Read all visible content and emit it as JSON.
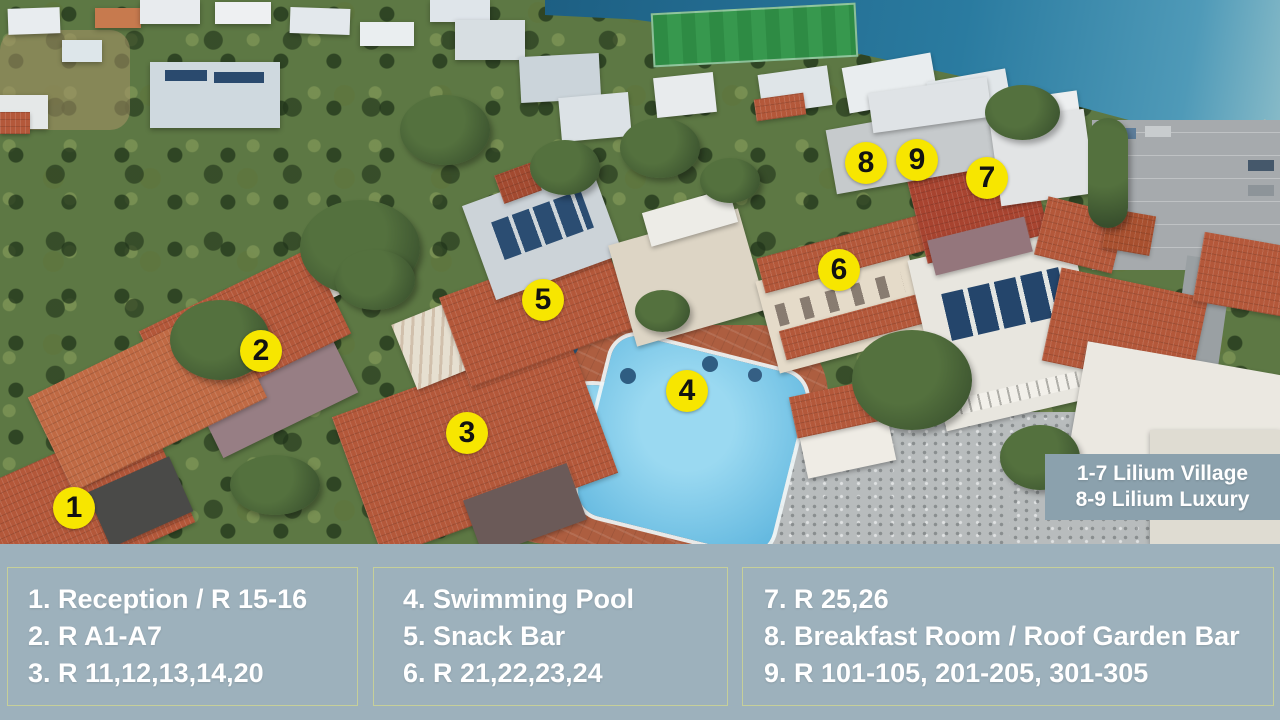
{
  "scene": {
    "markers": [
      {
        "n": "1"
      },
      {
        "n": "2"
      },
      {
        "n": "3"
      },
      {
        "n": "4"
      },
      {
        "n": "5"
      },
      {
        "n": "6"
      },
      {
        "n": "7"
      },
      {
        "n": "8"
      },
      {
        "n": "9"
      }
    ],
    "area_label": {
      "line1": "1-7 Lilium Village",
      "line2": "8-9 Lilium Luxury"
    }
  },
  "legend": {
    "columns": [
      {
        "items": [
          "1. Reception / R 15-16",
          "2. R A1-A7",
          "3. R 11,12,13,14,20"
        ]
      },
      {
        "items": [
          "4. Swimming Pool",
          "5. Snack Bar",
          "6. R 21,22,23,24"
        ]
      },
      {
        "items": [
          "7. R 25,26",
          "8. Breakfast Room / Roof Garden Bar",
          "9. R 101-105, 201-205, 301-305"
        ]
      }
    ]
  },
  "colors": {
    "marker_bg": "#f7e600",
    "marker_text": "#121212",
    "legend_bg": "#9db1bc",
    "legend_border": "#c6cf99",
    "legend_text": "#ffffff",
    "area_label_bg": "#8ba1ad",
    "area_label_text": "#ffffff",
    "sea": "#2a7ba0",
    "pool": "#6cc0e4",
    "roof_terracotta": "#b4583a"
  }
}
